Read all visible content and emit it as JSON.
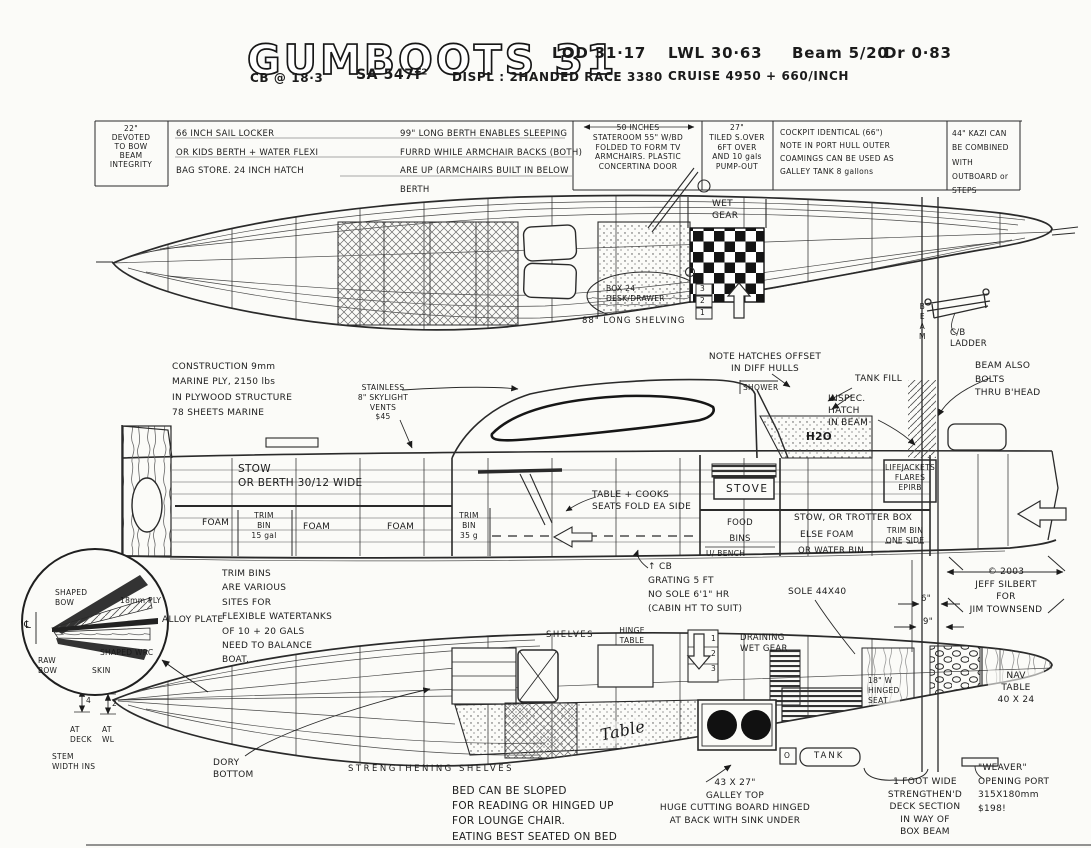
{
  "header": {
    "title": "GUMBOOTS 31",
    "lod": "LOD 31·17",
    "lwl": "LWL 30·63",
    "beam": "Beam 5/20",
    "draft": "Dr 0·83",
    "cb": "CB @ 18·3",
    "sa": "SA 547f²",
    "displ": "DISPL : 2HANDED RACE 3380",
    "cruise": "CRUISE 4950 + 660/INCH"
  },
  "spec_table": {
    "bow": "22\"\nDEVOTED\nTO BOW\nBEAM\nINTEGRITY",
    "sail_locker": "66 INCH SAIL LOCKER\nOR KIDS BERTH + WATER FLEXI\nBAG STORE. 24 INCH HATCH",
    "berth": "99\" LONG BERTH ENABLES SLEEPING\nFURRD WHILE ARMCHAIR BACKS (BOTH)\nARE UP (ARMCHAIRS BUILT IN BELOW BERTH",
    "stateroom": "50 INCHES\nSTATEROOM 55\" W/BD\nFOLDED TO FORM TV\nARMCHAIRS. PLASTIC\nCONCERTINA DOOR",
    "shower": "27\"\nTILED S.OVER\n6FT OVER\nAND 10 gals\nPUMP-OUT",
    "cockpit": "COCKPIT IDENTICAL (66\")\nNOTE IN PORT HULL OUTER\nCOAMINGS CAN BE USED AS\nGALLEY TANK 8 gallons",
    "kazi": "44\" KAZI CAN\nBE COMBINED WITH\nOUTBOARD or STEPS"
  },
  "top_view": {
    "wet_gear": "WET\nGEAR",
    "box24": "BOX 24\nDESK/DRAWER",
    "shelving": "88\" LONG SHELVING",
    "steps": "3\n2\n1",
    "cb_ladder": "C/B\nLADDER",
    "beam": "BEAM"
  },
  "profile_view": {
    "construction": "CONSTRUCTION 9mm\nMARINE PLY, 2150 lbs\nIN PLYWOOD STRUCTURE\n78 SHEETS MARINE",
    "vents": "STAINLESS\n8\" SKYLIGHT\nVENTS\n$45",
    "hatches": "NOTE HATCHES OFFSET\nIN DIFF HULLS",
    "tank_fill": "TANK FILL",
    "inspec": "INSPEC.\nHATCH\nIN BEAM",
    "beam_bolts": "BEAM ALSO\nBOLTS\nTHRU B'HEAD",
    "shower": "SHOWER",
    "stow_berth": "STOW\nOR BERTH 30/12 WIDE",
    "foam": "FOAM",
    "trim_bin_15": "TRIM\nBIN\n15 gal",
    "trim_bin_35": "TRIM\nBIN\n35 g",
    "table_cooks": "TABLE + COOKS\nSEATS FOLD EA SIDE",
    "stove": "STOVE",
    "food_bins": "FOOD\nBINS",
    "u_bench": "U/ BENCH",
    "stow_trotter": "STOW, OR TROTTER BOX",
    "else_foam": "ELSE FOAM",
    "or_water": "OR WATER BIN",
    "trim_bin_side": "TRIM BIN\nONE SIDE",
    "lifejackets": "LIFEJACKETS\nFLARES\nEPIRB",
    "h2o": "H2O"
  },
  "notes": {
    "trim_bins": "TRIM BINS\nARE VARIOUS\nSITES FOR\nFLEXIBLE WATERTANKS\nOF 10 + 20 GALS\nNEED TO BALANCE\nBOAT.",
    "cb_grating": "↑ CB\nGRATING 5 FT\nNO SOLE 6'1\" HR\n(CABIN HT TO SUIT)",
    "sole": "SOLE 44X40",
    "copyright": "© 2003\nJEFF SILBERT\nFOR\nJIM TOWNSEND",
    "dim6": "6\"",
    "dim9": "9\"",
    "bed": "BED CAN BE SLOPED\nFOR READING OR HINGED UP\nFOR LOUNGE CHAIR.\nEATING BEST SEATED ON BED",
    "galley": "43 X 27\"\nGALLEY TOP\nHUGE CUTTING BOARD HINGED\nAT BACK WITH SINK UNDER",
    "deck_section": "1 FOOT WIDE\nSTRENGTHEN'D\nDECK SECTION\nIN WAY OF\nBOX BEAM",
    "weaver": "\"WEAVER\"\nOPENING PORT\n315X180mm\n$198!",
    "dory": "DORY\nBOTTOM",
    "at_deck": "AT\nDECK",
    "at_wl": "AT\nWL",
    "stem": "STEM\nWIDTH INS",
    "dim4": "4",
    "dim2": "2"
  },
  "bow_detail": {
    "shaped_bow": "SHAPED\nBOW",
    "ply": "18mm PLY",
    "alloy": "ALLOY PLATE",
    "wrc": "SHAPED WRC",
    "raw_bow": "RAW\nBOW",
    "skin": "SKIN",
    "cl": "℄"
  },
  "bottom_view": {
    "shelves": "SHELVES",
    "hinge_table": "HINGE\nTABLE",
    "steps": "1\n2\n3",
    "draining": "DRAINING\nWET GEAR",
    "table": "Table",
    "tank": "TANK",
    "o": "O",
    "hinged_seat": "18\" W\nHINGED\nSEAT",
    "nav_table": "NAV\nTABLE\n40 X 24",
    "strengthening": "STRENGTHENING SHELVES"
  },
  "colors": {
    "ink": "#1b1b1b",
    "paper": "#fbfbf8"
  }
}
